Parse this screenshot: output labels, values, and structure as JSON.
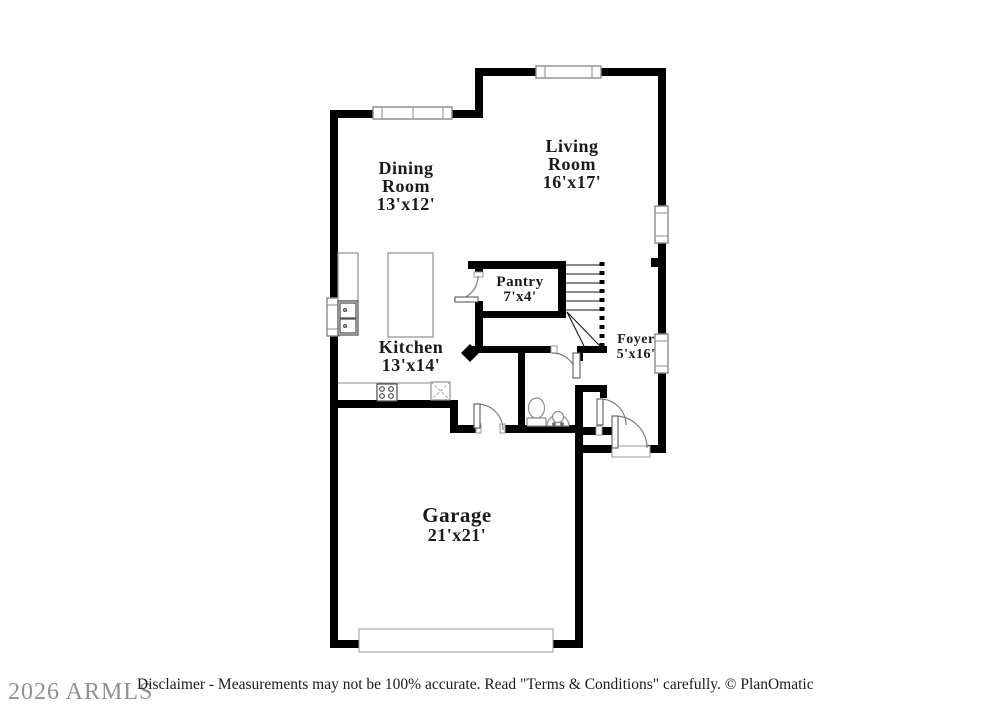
{
  "rooms": {
    "dining": {
      "line1": "Dining",
      "line2": "Room",
      "dims": "13'x12'"
    },
    "living": {
      "line1": "Living",
      "line2": "Room",
      "dims": "16'x17'"
    },
    "pantry": {
      "line1": "Pantry",
      "dims": "7'x4'"
    },
    "foyer": {
      "line1": "Foyer",
      "dims": "5'x16'"
    },
    "kitchen": {
      "line1": "Kitchen",
      "dims": "13'x14'"
    },
    "garage": {
      "line1": "Garage",
      "dims": "21'x21'"
    }
  },
  "footer": {
    "watermark": "2026 ARMLS",
    "disclaimer": "Disclaimer - Measurements may not be 100% accurate. Read \"Terms & Conditions\" carefully. © PlanOmatic"
  },
  "colors": {
    "background": "#ffffff",
    "wall": "#000000",
    "fixture_outline": "#8f8f8f",
    "label_text": "#1b1b1b",
    "watermark_gray": "#8d9298"
  }
}
